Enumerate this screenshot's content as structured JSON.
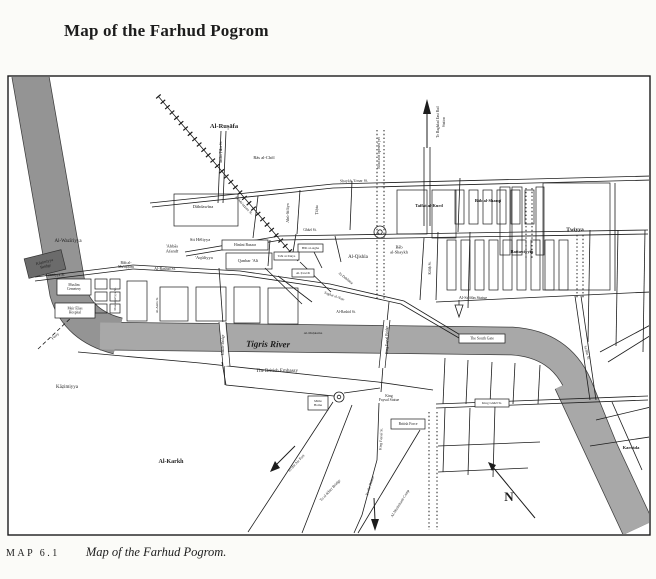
{
  "page": {
    "title": "Map of the Farhud Pogrom",
    "caption_tag": "MAP 6.1",
    "caption_text": "Map of the Farhud Pogrom."
  },
  "colors": {
    "ink": "#1c1c1c",
    "paper": "#fbfbf8",
    "map_bg": "#ffffff",
    "river": "#a8a8a8",
    "river_dark": "#949494",
    "bridge_box": "#6b6b6b"
  },
  "map": {
    "river": [
      {
        "d": "M30,74 L68,292 Q78,326 118,336",
        "w": 36,
        "c": "#949494"
      },
      {
        "d": "M100,336 L512,341 Q560,344 578,385 L636,528",
        "w": 27,
        "c": "#a8a8a8"
      },
      {
        "d": "M570,382 L638,528",
        "w": 32,
        "c": "#a8a8a8"
      }
    ],
    "streets_solid": [
      "333,184 652,176",
      "333,188 652,180",
      "150,203 333,184",
      "152,207 333,188",
      "221,131 218,203",
      "226,131 223,203",
      "185,252 280,236 648,230",
      "186,256 281,240 648,234",
      "133,265 240,271 330,284 404,301 462,336",
      "133,269 240,275 328,288 401,304 459,338",
      "35,277 133,265",
      "35,281 133,269",
      "258,196 253,238",
      "300,190 297,234",
      "352,181 350,230",
      "424,147 424,179",
      "430,147 430,179",
      "424,179 424,226",
      "430,179 430,226",
      "424,238 420,300",
      "460,178 458,232",
      "615,183 615,291",
      "438,232 436,300",
      "470,232 468,308",
      "590,230 588,342",
      "618,230 616,346",
      "645,230 643,352",
      "436,302 650,292",
      "296,234 293,252",
      "270,240 268,266",
      "300,262 331,292",
      "278,276 312,302",
      "314,252 322,268",
      "335,236 341,262",
      "265,268 302,304",
      "78,352 200,363 330,377 378,382",
      "378,382 433,390",
      "222,362 226,385 334,396",
      "219,268 223,324",
      "224,364 225,385",
      "389,302 387,322",
      "383,366 381,392",
      "344,393 380,388",
      "333,402 248,532",
      "352,405 302,533",
      "379,403 377,460 362,515 354,533",
      "420,430 358,533",
      "436,404 648,396",
      "436,408 648,400",
      "445,358 443,404",
      "468,360 466,404",
      "492,362 490,404",
      "515,363 513,404",
      "540,365 538,404",
      "445,408 443,472",
      "470,408 468,475",
      "495,406 493,477",
      "438,446 540,442",
      "438,472 528,468",
      "596,420 655,406",
      "590,446 656,436",
      "612,402 642,470",
      "600,352 656,322",
      "608,362 656,332",
      "575,296 590,400",
      "581,296 596,400"
    ],
    "streets_dotted": [
      "377,130 377,300",
      "384,130 384,300",
      "526,188 526,258",
      "532,188 532,258",
      "577,235 577,298",
      "583,235 583,298",
      "429,412 429,530",
      "437,412 437,530"
    ],
    "streets_dashed": [
      "38,349 74,315"
    ],
    "railway": [
      "158,96 298,261"
    ],
    "bridges": [
      {
        "deck": "222,322 226,366",
        "edges": [
          "219,322 223,366",
          "226,322 230,366"
        ]
      },
      {
        "deck": "387,320 382,368",
        "edges": [
          "384,320 379,368",
          "390,320 385,368"
        ]
      }
    ],
    "rects": [
      [
        397,
        190,
        30,
        44
      ],
      [
        432,
        190,
        24,
        48
      ],
      [
        500,
        187,
        10,
        68
      ],
      [
        512,
        187,
        10,
        68
      ],
      [
        536,
        187,
        8,
        68
      ],
      [
        543,
        183,
        67,
        107
      ],
      [
        95,
        279,
        12,
        10
      ],
      [
        95,
        292,
        12,
        9
      ],
      [
        95,
        304,
        12,
        9
      ],
      [
        110,
        279,
        10,
        10
      ],
      [
        110,
        292,
        10,
        9
      ],
      [
        110,
        304,
        10,
        9
      ],
      [
        127,
        281,
        20,
        40
      ],
      [
        160,
        287,
        28,
        34
      ],
      [
        196,
        287,
        30,
        34
      ],
      [
        234,
        287,
        26,
        36
      ],
      [
        268,
        288,
        30,
        36
      ],
      [
        174,
        194,
        64,
        32
      ],
      [
        226,
        253,
        46,
        16
      ]
    ],
    "rect_groups": [
      {
        "x": 455,
        "y": 190,
        "w": 9,
        "h": 34,
        "dx": 14,
        "count": 6
      },
      {
        "x": 447,
        "y": 240,
        "w": 9,
        "h": 50,
        "dx": 14,
        "count": 9
      }
    ],
    "circles": [
      [
        380,
        232,
        6
      ],
      [
        380,
        232,
        2.2
      ],
      [
        339,
        397,
        5
      ],
      [
        339,
        397,
        1.8
      ]
    ],
    "arrows": [
      {
        "n": "rail-arrow",
        "line": "427,112 427,148",
        "head": "423,114 427,99 431,114"
      },
      {
        "n": "palace-arrow",
        "line": "374,498 375,520",
        "head": "371,519 379,519 375,531"
      },
      {
        "n": "airport-arrow",
        "line": "295,446 275,466",
        "head": "270,472 280,468 275,461"
      }
    ],
    "compass": {
      "line": "535,518 492,466",
      "head": "488,462 496,465 492,471"
    },
    "monument": {
      "poly": "455,305 463,305 459,317",
      "stem": "459,300 459,305"
    },
    "boxes": [
      {
        "n": "hinuni-bazaar",
        "t": "Hinūni Bazaar",
        "x": 222,
        "y": 240,
        "w": 46,
        "h": 10,
        "s": 3.8
      },
      {
        "n": "bab-al-agha",
        "t": "Bāb al-Agha",
        "x": 298,
        "y": 244,
        "w": 25,
        "h": 8,
        "s": 3.4
      },
      {
        "n": "taht-al-takya",
        "t": "Taht al-Takya",
        "x": 274,
        "y": 252,
        "w": 25,
        "h": 8,
        "s": 3.2
      },
      {
        "n": "al-tawrat",
        "t": "Al-Ṭawrāt",
        "x": 292,
        "y": 269,
        "w": 22,
        "h": 8,
        "s": 3.4
      },
      {
        "n": "muslim-cemetery",
        "lines": [
          "Muslim",
          "Cemetery"
        ],
        "x": 57,
        "y": 279,
        "w": 34,
        "h": 16,
        "s": 3.6
      },
      {
        "n": "meir-elias-hospital",
        "lines": [
          "Meir Elias",
          "Hospital"
        ],
        "x": 55,
        "y": 303,
        "w": 40,
        "h": 15,
        "s": 3.6
      },
      {
        "n": "south-gate",
        "t": "The South Gate",
        "x": 459,
        "y": 334,
        "w": 46,
        "h": 9,
        "s": 3.8
      },
      {
        "n": "king-ghazi-st",
        "t": "King Ghāzī St.",
        "x": 475,
        "y": 399,
        "w": 34,
        "h": 8,
        "s": 3.4
      },
      {
        "n": "mede-home",
        "lines": [
          "Mēde",
          "Home"
        ],
        "x": 308,
        "y": 396,
        "w": 20,
        "h": 14,
        "s": 3.4
      },
      {
        "n": "british-force",
        "t": "British Force",
        "x": 391,
        "y": 419,
        "w": 34,
        "h": 10,
        "s": 3.6
      },
      {
        "n": "kadhimiyya-bridge",
        "lines": [
          "Kāẓimiyya",
          "Bridge"
        ],
        "x": 26,
        "y": 254,
        "w": 38,
        "h": 20,
        "s": 4,
        "dark": 1,
        "r": -14
      }
    ],
    "labels": [
      {
        "n": "al-rusafa",
        "t": "Al-Ruṣāfa",
        "x": 224,
        "y": 128,
        "s": 6.5,
        "b": 1
      },
      {
        "n": "ras-al-chol",
        "t": "Rās al-Chōl",
        "x": 264,
        "y": 159,
        "s": 4.5
      },
      {
        "n": "imam-taha-st",
        "t": "Imām Ṭāha St.",
        "x": 222,
        "y": 152,
        "s": 3.6,
        "r": -90
      },
      {
        "n": "dahdawina",
        "t": "Dāhdawīna",
        "x": 203,
        "y": 208,
        "s": 4.5
      },
      {
        "n": "abu-sifayn-st",
        "t": "Abū-Sifāyn",
        "x": 289,
        "y": 213,
        "s": 4.2,
        "r": -90
      },
      {
        "n": "tahta-st",
        "t": "Ṭāḥta",
        "x": 318,
        "y": 210,
        "s": 4.2,
        "r": -90
      },
      {
        "n": "shaykh-umar-st",
        "t": "Shaykh 'Umar St.",
        "x": 354,
        "y": 182,
        "s": 4,
        "r": -1
      },
      {
        "n": "road-not-opened",
        "t": "Road not opened yet",
        "x": 380,
        "y": 153,
        "s": 3.8,
        "r": -90
      },
      {
        "n": "to-east-rail-1",
        "t": "To Baghdad East Rail",
        "x": 439,
        "y": 122,
        "s": 3.6,
        "r": -90
      },
      {
        "n": "to-east-rail-2",
        "t": "Station",
        "x": 445,
        "y": 122,
        "s": 3.6,
        "r": -90
      },
      {
        "n": "taffat-al-kurd",
        "t": "Taffat al-Kurd",
        "x": 429,
        "y": 207,
        "s": 4.4,
        "b": 1
      },
      {
        "n": "bab-al-sharqi",
        "t": "Bāb al-Sharqī",
        "x": 488,
        "y": 202,
        "s": 4.4,
        "b": 1
      },
      {
        "n": "twiyya",
        "t": "Ṭwiyya",
        "x": 575,
        "y": 231,
        "s": 5.5,
        "b": 1
      },
      {
        "n": "battawiyyin",
        "t": "Battawiyyīn",
        "x": 522,
        "y": 253,
        "s": 4.4,
        "b": 1
      },
      {
        "n": "bab-al-shaykh",
        "lines": [
          "Bāb",
          "al-Shaykh"
        ],
        "x": 399,
        "y": 251,
        "s": 4.4
      },
      {
        "n": "kifah-st",
        "t": "Kifāḥ St.",
        "x": 431,
        "y": 268,
        "s": 3.6,
        "r": -90
      },
      {
        "n": "ghazi-st",
        "t": "Ghāzī St.",
        "x": 310,
        "y": 231,
        "s": 3.6
      },
      {
        "n": "al-qishla",
        "t": "Al-Qishla",
        "x": 358,
        "y": 258,
        "s": 5
      },
      {
        "n": "al-dahhana",
        "t": "Al-Dahhāna",
        "x": 345,
        "y": 279,
        "s": 3.6,
        "r": 38
      },
      {
        "n": "saghat-al-nasr",
        "t": "Saghat al-Naṣr",
        "x": 334,
        "y": 297,
        "s": 3.6,
        "r": 20
      },
      {
        "n": "qanbar-ali",
        "t": "Qanbar 'Ali",
        "x": 248,
        "y": 262,
        "s": 4.4
      },
      {
        "n": "sit-heliyya",
        "t": "Sit Hēliyya",
        "x": 200,
        "y": 241,
        "s": 4.5
      },
      {
        "n": "abbas-afandi",
        "lines": [
          "'Abbās",
          "Afandī"
        ],
        "x": 172,
        "y": 250,
        "s": 4.5
      },
      {
        "n": "aquliyya",
        "t": "'Aqūliyya",
        "x": 204,
        "y": 259,
        "s": 4.5
      },
      {
        "n": "bab-al-muazzam",
        "lines": [
          "Bāb al-",
          "Mu'aẓẓam"
        ],
        "x": 126,
        "y": 266,
        "s": 3.8
      },
      {
        "n": "al-rashid-st",
        "t": "Al-Rashid St.",
        "x": 165,
        "y": 270,
        "s": 4
      },
      {
        "n": "al-rashid-st-2",
        "t": "Al-Rashid St.",
        "x": 346,
        "y": 313,
        "s": 3.6
      },
      {
        "n": "al-mahkama",
        "t": "Al-Maḥkama",
        "x": 313,
        "y": 334,
        "s": 3.5
      },
      {
        "n": "al-waziriyya",
        "t": "Al-Wazīriyya",
        "x": 68,
        "y": 242,
        "s": 5
      },
      {
        "n": "azamiyya-st",
        "t": "A'ẓamiyya St.",
        "x": 55,
        "y": 276,
        "s": 3.6
      },
      {
        "n": "mustansiriyya-st",
        "t": "Mustanṣiriyya St.",
        "x": 116,
        "y": 299,
        "s": 3.3,
        "r": -90
      },
      {
        "n": "al-amin-st",
        "t": "Al-Amīn St.",
        "x": 158,
        "y": 305,
        "s": 3.3,
        "r": -90
      },
      {
        "n": "muazzam-st",
        "t": "Al-Mu'aẓẓam St.",
        "x": 243,
        "y": 206,
        "s": 3.6,
        "r": 47
      },
      {
        "n": "tigris-river",
        "t": "Tigris River",
        "x": 268,
        "y": 347,
        "s": 9,
        "i": 1,
        "b": 1,
        "r": 1
      },
      {
        "n": "british-embassy",
        "t": "The British Embassy",
        "x": 277,
        "y": 372,
        "s": 5
      },
      {
        "n": "ferry",
        "t": "Ferry",
        "x": 56,
        "y": 337,
        "s": 4,
        "r": -42
      },
      {
        "n": "maude-bridge",
        "t": "Maude Bridge",
        "x": 224,
        "y": 345,
        "s": 3.6,
        "r": -90
      },
      {
        "n": "king-faysal-bridge",
        "t": "King Faysal Bridge",
        "x": 388,
        "y": 340,
        "s": 3.6,
        "r": -90
      },
      {
        "n": "al-sadun-statue",
        "t": "Al-Sa'dūn Statue",
        "x": 473,
        "y": 299,
        "s": 4.2
      },
      {
        "n": "karrada",
        "t": "Karrāda",
        "x": 631,
        "y": 449,
        "s": 4.5,
        "b": 1
      },
      {
        "n": "kazimiyya",
        "t": "Kāẓimiyya",
        "x": 67,
        "y": 388,
        "s": 5
      },
      {
        "n": "al-karkh",
        "t": "Al-Karkh",
        "x": 171,
        "y": 463,
        "s": 6,
        "b": 1
      },
      {
        "n": "king-faysal-statue",
        "lines": [
          "King",
          "Faysal Statue"
        ],
        "x": 389,
        "y": 399,
        "s": 3.8
      },
      {
        "n": "king-faysal-st",
        "t": "King Faysal St.",
        "x": 382,
        "y": 439,
        "s": 3.6,
        "r": -87
      },
      {
        "n": "to-the-palace",
        "t": "To the Palace",
        "x": 371,
        "y": 486,
        "s": 3.8,
        "r": -72
      },
      {
        "n": "washshash-camp",
        "t": "Al-Washshash Camp",
        "x": 401,
        "y": 504,
        "s": 3.8,
        "r": -58
      },
      {
        "n": "to-air-port",
        "t": "To the Air Port",
        "x": 297,
        "y": 464,
        "s": 3.8,
        "r": -47
      },
      {
        "n": "to-khirr-bridge",
        "t": "To al-Khirr Bridge",
        "x": 331,
        "y": 491,
        "s": 3.8,
        "r": -47
      },
      {
        "n": "sadun-st",
        "t": "Sa'dūn St.",
        "x": 586,
        "y": 353,
        "s": 3.6,
        "r": 75
      },
      {
        "n": "compass-n",
        "t": "N",
        "x": 509,
        "y": 501,
        "s": 13,
        "b": 1
      }
    ]
  }
}
